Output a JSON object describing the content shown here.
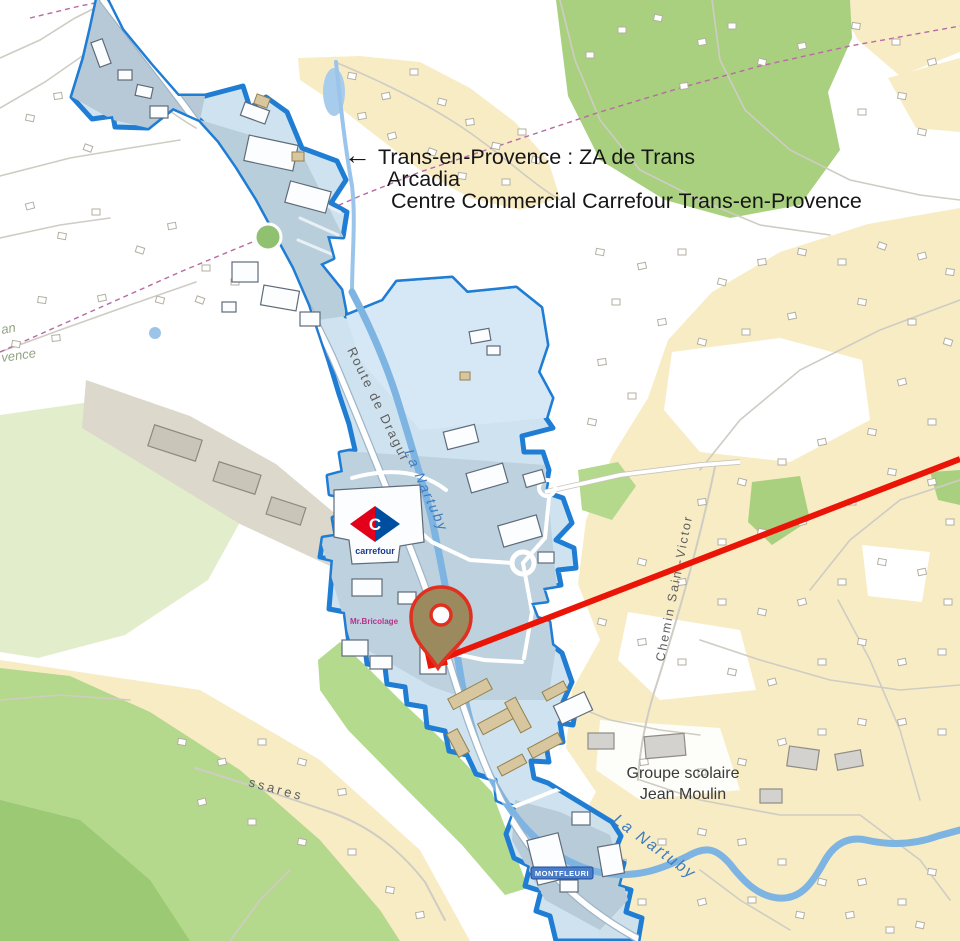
{
  "annotation": {
    "arrow_icon": "←",
    "line1": "Trans-en-Provence : ZA de Trans",
    "line2": "Arcadia",
    "line3": "Centre Commercial Carrefour Trans-en-Provence"
  },
  "map_labels": {
    "main_road": "Route de Dragui",
    "river_upper": "La Nartuby",
    "river_lower": "La Nartuby",
    "chemin_saint_victor": "Chemin Saint-Victor",
    "road_ssares": "ssares",
    "school_line1": "Groupe scolaire",
    "school_line2": "Jean Moulin",
    "edge_label_top": "an",
    "edge_label_bottom": "vence",
    "store_mr_bricolage": "Mr.Bricolage",
    "badge_montfleuri": "MONTFLEURI",
    "carrefour_logo_letter": "C",
    "carrefour_logo_text": "carrefour"
  },
  "colors": {
    "zone_outline": "#1f7dd4",
    "zone_fill": "#cadfee",
    "red_line": "#ea1507",
    "pin_fill": "#9a8a5e",
    "pin_stroke": "#e0301f",
    "residential_fill": "#f8ecc5",
    "green_fill": "#a9d07f",
    "river_blue": "#7db4e2",
    "boundary_dashed": "#b76aa4"
  }
}
